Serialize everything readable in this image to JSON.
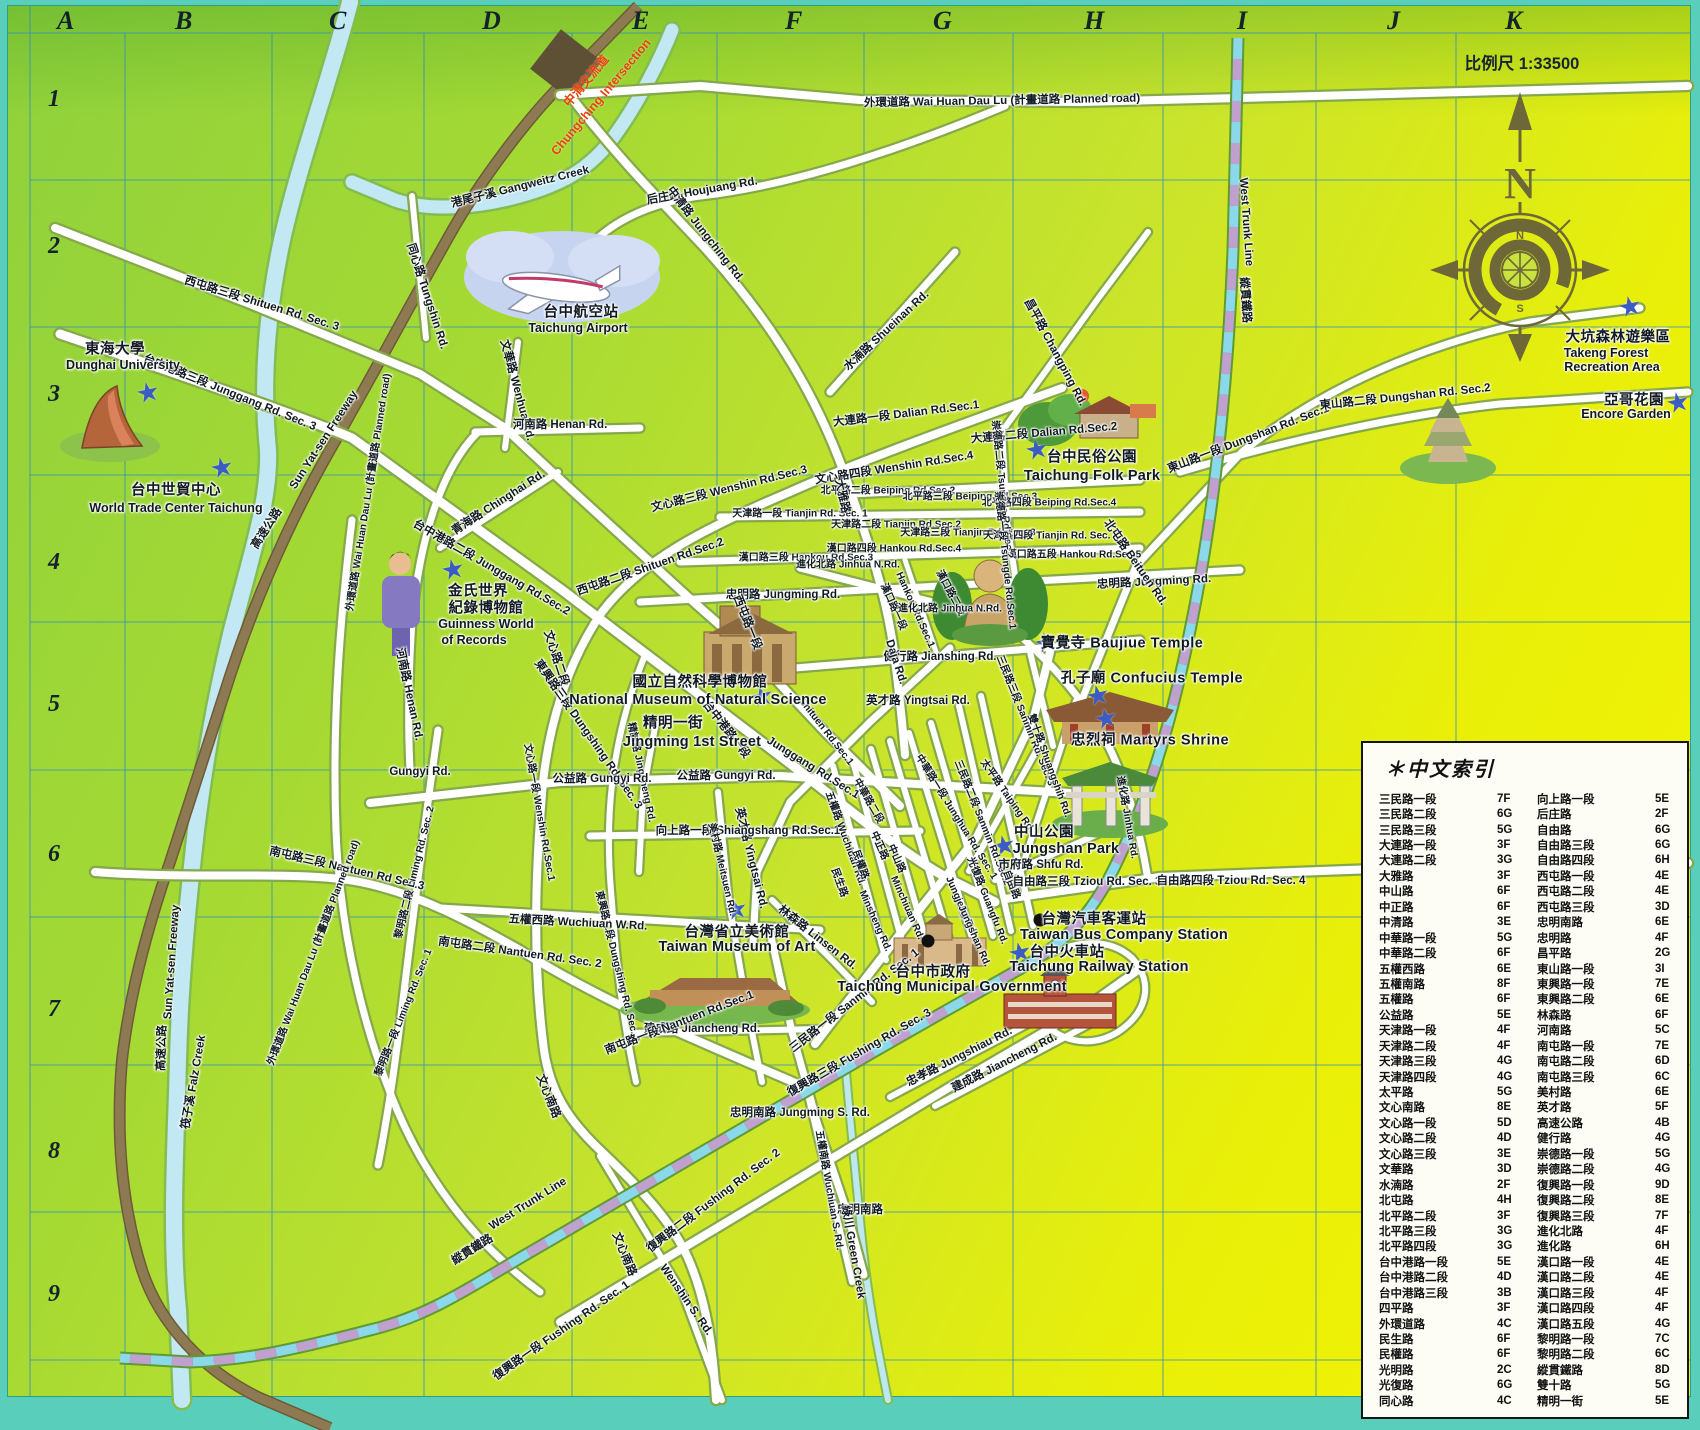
{
  "map": {
    "scale_label": "比例尺 1:33500",
    "compass": {
      "north": "N",
      "south": "S"
    },
    "grid": {
      "cols": [
        "A",
        "B",
        "C",
        "D",
        "E",
        "F",
        "G",
        "H",
        "I",
        "J",
        "K"
      ],
      "rows": [
        "1",
        "2",
        "3",
        "4",
        "5",
        "6",
        "7",
        "8",
        "9"
      ]
    },
    "index": {
      "title": "＊中文索引",
      "rows": [
        [
          "三民路一段",
          "7F",
          "向上路一段",
          "5E"
        ],
        [
          "三民路二段",
          "6G",
          "后庄路",
          "2F"
        ],
        [
          "三民路三段",
          "5G",
          "自由路",
          "6G"
        ],
        [
          "大連路一段",
          "3F",
          "自由路三段",
          "6G"
        ],
        [
          "大連路二段",
          "3G",
          "自由路四段",
          "6H"
        ],
        [
          "大雅路",
          "3F",
          "西屯路一段",
          "4E"
        ],
        [
          "中山路",
          "6F",
          "西屯路二段",
          "4E"
        ],
        [
          "中正路",
          "6F",
          "西屯路三段",
          "3D"
        ],
        [
          "中清路",
          "3E",
          "忠明南路",
          "6E"
        ],
        [
          "中華路一段",
          "5G",
          "忠明路",
          "4F"
        ],
        [
          "中華路二段",
          "6F",
          "昌平路",
          "2G"
        ],
        [
          "五權西路",
          "6E",
          "東山路一段",
          "3I"
        ],
        [
          "五權南路",
          "8F",
          "東興路一段",
          "7E"
        ],
        [
          "五權路",
          "6F",
          "東興路二段",
          "6E"
        ],
        [
          "公益路",
          "5E",
          "林森路",
          "6F"
        ],
        [
          "天津路一段",
          "4F",
          "河南路",
          "5C"
        ],
        [
          "天津路二段",
          "4F",
          "南屯路一段",
          "7E"
        ],
        [
          "天津路三段",
          "4G",
          "南屯路二段",
          "6D"
        ],
        [
          "天津路四段",
          "4G",
          "南屯路三段",
          "6C"
        ],
        [
          "太平路",
          "5G",
          "美村路",
          "6E"
        ],
        [
          "文心南路",
          "8E",
          "英才路",
          "5F"
        ],
        [
          "文心路一段",
          "5D",
          "高速公路",
          "4B"
        ],
        [
          "文心路二段",
          "4D",
          "健行路",
          "4G"
        ],
        [
          "文心路三段",
          "3E",
          "崇德路一段",
          "5G"
        ],
        [
          "文華路",
          "3D",
          "崇德路二段",
          "4G"
        ],
        [
          "水湳路",
          "2F",
          "復興路一段",
          "9D"
        ],
        [
          "北屯路",
          "4H",
          "復興路二段",
          "8E"
        ],
        [
          "北平路二段",
          "3F",
          "復興路三段",
          "7F"
        ],
        [
          "北平路三段",
          "3G",
          "進化北路",
          "4F"
        ],
        [
          "北平路四段",
          "3G",
          "進化路",
          "6H"
        ],
        [
          "台中港路一段",
          "5E",
          "漢口路一段",
          "4E"
        ],
        [
          "台中港路二段",
          "4D",
          "漢口路二段",
          "4E"
        ],
        [
          "台中港路三段",
          "3B",
          "漢口路三段",
          "4F"
        ],
        [
          "四平路",
          "3F",
          "漢口路四段",
          "4F"
        ],
        [
          "外環道路",
          "4C",
          "漢口路五段",
          "4G"
        ],
        [
          "民生路",
          "6F",
          "黎明路一段",
          "7C"
        ],
        [
          "民權路",
          "6F",
          "黎明路二段",
          "6C"
        ],
        [
          "光明路",
          "2C",
          "縱貫鐵路",
          "8D"
        ],
        [
          "光復路",
          "6G",
          "雙十路",
          "5G"
        ],
        [
          "同心路",
          "4C",
          "精明一街",
          "5E"
        ]
      ]
    },
    "labels": [
      [
        "外環道路 Wai Huan Dau Lu (計畫道路 Planned road)",
        1002,
        100,
        -1,
        ""
      ],
      [
        "后庄路 Houjuang Rd.",
        702,
        190,
        -10,
        ""
      ],
      [
        "港尾子溪 Gangweitz Creek",
        520,
        186,
        -14,
        ""
      ],
      [
        "中清路 Jungching Rd.",
        706,
        234,
        52,
        ""
      ],
      [
        "西屯路三段 Shituen Rd. Sec. 3",
        262,
        303,
        17,
        ""
      ],
      [
        "台中港路三段 Junggang Rd. Sec. 3",
        230,
        392,
        22,
        ""
      ],
      [
        "水湳路 Shueinan Rd.",
        886,
        330,
        -43,
        ""
      ],
      [
        "同心路 Tungshin Rd.",
        428,
        296,
        72,
        ""
      ],
      [
        "文華路 Wenhua Rd.",
        518,
        390,
        75,
        ""
      ],
      [
        "河南路 Henan Rd.",
        560,
        424,
        0,
        ""
      ],
      [
        "河南路 Henan Rd.",
        410,
        694,
        78,
        ""
      ],
      [
        "東山路一段 Dungshan Rd. Sec.1",
        1248,
        438,
        -21,
        ""
      ],
      [
        "東山路二段 Dungshan Rd. Sec.2",
        1405,
        396,
        -6,
        ""
      ],
      [
        "昌平路 Changping Rd.",
        1056,
        352,
        62,
        ""
      ],
      [
        "大連路一段 Dalian Rd.Sec.1",
        906,
        413,
        -7,
        ""
      ],
      [
        "大連路二段 Dalian Rd.Sec.2",
        1044,
        432,
        -5,
        ""
      ],
      [
        "文心路四段 Wenshin Rd.Sec.4",
        894,
        467,
        -9,
        ""
      ],
      [
        "北平路二段 Beiping Rd.Sec.2",
        888,
        489,
        0,
        "sm"
      ],
      [
        "北平路三段 Beiping Rd.Sec.3",
        970,
        495,
        0,
        "sm"
      ],
      [
        "北平路四段 Beiping Rd.Sec.4",
        1049,
        501,
        0,
        "sm"
      ],
      [
        "天津路一段 Tianjin Rd. Sec. 1",
        800,
        512,
        0,
        "sm"
      ],
      [
        "天津路二段 Tianjin Rd.Sec.2",
        896,
        523,
        0,
        "sm"
      ],
      [
        "天津路三段 Tianjin Rd. Sec. 3",
        968,
        531,
        0,
        "sm"
      ],
      [
        "天津路四段 Tianjin Rd. Sec. 4",
        1051,
        534,
        0,
        "sm"
      ],
      [
        "西屯路二段 Shituen Rd.Sec.2",
        650,
        566,
        -19,
        ""
      ],
      [
        "漢口路三段 Hankou Rd.Sec.3",
        806,
        556,
        0,
        "sm"
      ],
      [
        "漢口路四段 Hankou Rd.Sec.4",
        894,
        547,
        0,
        "sm"
      ],
      [
        "漢口路五段 Hankou Rd.Sec.5",
        1074,
        553,
        0,
        "sm"
      ],
      [
        "漢口路一段",
        895,
        606,
        66,
        "sm"
      ],
      [
        "Hankou Rd.Sec.1",
        915,
        610,
        66,
        "sm"
      ],
      [
        "漢口路二段",
        952,
        592,
        62,
        "sm"
      ],
      [
        "忠明路 Jungming Rd.",
        783,
        594,
        0,
        ""
      ],
      [
        "忠明路 Jungming Rd.",
        1154,
        581,
        -3,
        ""
      ],
      [
        "進化北路 Jinhua N.Rd.",
        848,
        563,
        0,
        "sm"
      ],
      [
        "進化北路 Jinhua N.Rd.",
        950,
        607,
        0,
        "sm"
      ],
      [
        "健行路 Jianshing Rd.",
        940,
        656,
        0,
        ""
      ],
      [
        "英才路 Yingtsai Rd.",
        918,
        700,
        0,
        ""
      ],
      [
        "英才路 Yingtsai Rd.",
        752,
        858,
        76,
        ""
      ],
      [
        "大雅路",
        843,
        496,
        78,
        ""
      ],
      [
        "Daja Rd.",
        896,
        662,
        72,
        ""
      ],
      [
        "北屯路 Beituen Rd.",
        1136,
        562,
        55,
        ""
      ],
      [
        "崇德路二段 Tsungde Rd.Sec.2",
        1004,
        489,
        84,
        "sm"
      ],
      [
        "崇德路一段 Tsungde Rd.Sec.1",
        1007,
        560,
        84,
        "sm"
      ],
      [
        "台中港路二段 Junggang Rd.Sec.2",
        492,
        567,
        30,
        ""
      ],
      [
        "台中港路一段",
        727,
        729,
        52,
        ""
      ],
      [
        "Junggang Rd.Sec.1",
        813,
        768,
        32,
        ""
      ],
      [
        "Shituen Rd.Sec.1",
        826,
        732,
        52,
        "sm"
      ],
      [
        "西屯路一段",
        748,
        622,
        68,
        ""
      ],
      [
        "文心路三段 Wenshin Rd.Sec.3",
        729,
        488,
        -14,
        ""
      ],
      [
        "文心路二段",
        557,
        658,
        72,
        ""
      ],
      [
        "文心路一段 Wenshin Rd.Sec.1",
        541,
        812,
        80,
        "sm"
      ],
      [
        "東興路三段 Dungshing Rd. Sec. 3",
        589,
        734,
        55,
        ""
      ],
      [
        "東興路二段 Dungshing Rd. Sec. 2",
        619,
        966,
        76,
        "sm"
      ],
      [
        "精誠路 Jingcheng Rd.",
        643,
        772,
        78,
        "sm"
      ],
      [
        "公益路 Gungyi Rd.",
        602,
        778,
        0,
        ""
      ],
      [
        "公益路 Gungyi Rd.",
        726,
        775,
        0,
        ""
      ],
      [
        "Gungyi Rd.",
        420,
        772,
        0,
        ""
      ],
      [
        "向上路一段 Shiangshang Rd.Sec.1",
        748,
        830,
        0,
        ""
      ],
      [
        "美村路 Meitsuen Rd.",
        724,
        869,
        77,
        "sm"
      ],
      [
        "林森路 Linsen Rd.",
        818,
        937,
        38,
        ""
      ],
      [
        "五權路 Wuchiuan Rd.",
        847,
        838,
        70,
        "sm"
      ],
      [
        "民生路",
        841,
        882,
        70,
        "sm"
      ],
      [
        "民權路",
        862,
        864,
        70,
        "sm"
      ],
      [
        "中正路",
        881,
        845,
        66,
        "sm"
      ],
      [
        "中山路",
        898,
        858,
        66,
        "sm"
      ],
      [
        "Minsheng Rd.",
        875,
        921,
        66,
        "sm"
      ],
      [
        "Minchiuan Rd.",
        907,
        908,
        66,
        "sm"
      ],
      [
        "Jungjeng Rd.",
        961,
        906,
        66,
        "sm"
      ],
      [
        "Jungshan Rd.",
        974,
        936,
        66,
        "sm"
      ],
      [
        "中華路一段 Junghua Rd. Sec. 1",
        958,
        816,
        58,
        "sm"
      ],
      [
        "中華路二段",
        870,
        800,
        60,
        "sm"
      ],
      [
        "太平路 Taiping Rd.",
        1009,
        795,
        55,
        "sm"
      ],
      [
        "三民路三段 Sanmin Rd. Sec. 3",
        1027,
        720,
        68,
        "sm"
      ],
      [
        "三民路二段 Sanmin Rd.Sec.2",
        984,
        822,
        68,
        "sm"
      ],
      [
        "三民路一段 Sanmin Rd. Sec. 1",
        854,
        1000,
        -38,
        ""
      ],
      [
        "雙十路 Shuangshih Rd.",
        1051,
        765,
        70,
        "sm"
      ],
      [
        "光復路 Guangfu Rd.",
        989,
        900,
        68,
        "sm"
      ],
      [
        "自由路",
        1013,
        884,
        68,
        "sm"
      ],
      [
        "市府路 Shfu Rd.",
        1041,
        864,
        0,
        ""
      ],
      [
        "自由路三段 Tziou Rd. Sec. 3",
        1087,
        881,
        0,
        ""
      ],
      [
        "自由路四段 Tziou Rd. Sec. 4",
        1231,
        880,
        0,
        ""
      ],
      [
        "進化路 Jinhua Rd.",
        1129,
        817,
        80,
        "sm"
      ],
      [
        "忠明南路 Jungming S. Rd.",
        800,
        1112,
        0,
        ""
      ],
      [
        "忠明南路",
        860,
        1209,
        0,
        ""
      ],
      [
        "五權南路 Wuchiuan S. Rd.",
        831,
        1190,
        80,
        "sm"
      ],
      [
        "綠川 Green Creek",
        854,
        1252,
        80,
        ""
      ],
      [
        "文心南路",
        549,
        1096,
        68,
        ""
      ],
      [
        "文心南路",
        625,
        1254,
        68,
        ""
      ],
      [
        "Wenshin S. Rd.",
        686,
        1300,
        55,
        ""
      ],
      [
        "復興路一段 Fushing Rd. Sec. 1",
        561,
        1330,
        -35,
        ""
      ],
      [
        "復興路二段 Fushing Rd. Sec. 2",
        713,
        1200,
        -37,
        ""
      ],
      [
        "復興路三段 Fushing Rd. Sec. 3",
        859,
        1052,
        -30,
        ""
      ],
      [
        "忠孝路 Jungshiau Rd.",
        959,
        1056,
        -27,
        ""
      ],
      [
        "建成路 Jiancheng Rd.",
        1004,
        1062,
        -27,
        ""
      ],
      [
        "建成路 Jiancheng Rd.",
        702,
        1028,
        0,
        ""
      ],
      [
        "南屯路一段 Nantuen Rd.Sec.1",
        679,
        1022,
        -21,
        ""
      ],
      [
        "南屯路二段 Nantuen Rd. Sec. 2",
        520,
        952,
        8,
        ""
      ],
      [
        "南屯路三段 Nantuen Rd Sec.3",
        347,
        868,
        13,
        ""
      ],
      [
        "黎明路二段 Liming Rd. Sec. 2",
        413,
        872,
        -76,
        "sm"
      ],
      [
        "黎明路一段 Liming Rd. Sec. 1",
        402,
        1012,
        -68,
        "sm"
      ],
      [
        "五權西路 Wuchiuan W.Rd.",
        578,
        922,
        3,
        ""
      ],
      [
        "外環道路 Wai Huan Dau Lu (計畫道路 Planned road)",
        367,
        492,
        -81,
        "sm"
      ],
      [
        "外環道路 Wai Huan Dau Lu (計畫道路 Planned road)",
        312,
        952,
        -69,
        "sm"
      ],
      [
        "Sun Yat-sen Freeway",
        324,
        440,
        -57,
        ""
      ],
      [
        "高速公路",
        266,
        528,
        -57,
        ""
      ],
      [
        "Sun Yat-sen Freeway",
        172,
        962,
        -86,
        ""
      ],
      [
        "高速公路",
        161,
        1048,
        -88,
        ""
      ],
      [
        "筏子溪 Falz Creek",
        193,
        1082,
        -80,
        ""
      ],
      [
        "青海路 Chinghai Rd.",
        498,
        502,
        -33,
        ""
      ],
      [
        "West Trunk Line",
        1246,
        222,
        86,
        ""
      ],
      [
        "縱貫鐵路",
        1246,
        300,
        86,
        ""
      ],
      [
        "West Trunk Line",
        528,
        1204,
        -32,
        ""
      ],
      [
        "縱貫鐵路",
        472,
        1249,
        -32,
        ""
      ],
      [
        "中清交流道",
        585,
        80,
        -50,
        "red"
      ],
      [
        "Chungching Intersection",
        601,
        97,
        -50,
        "red"
      ],
      [
        "東海大學",
        115,
        348,
        0,
        "lm"
      ],
      [
        "Dunghai University",
        123,
        365,
        0,
        "en"
      ],
      [
        "台中世貿中心",
        176,
        489,
        0,
        "lm"
      ],
      [
        "World Trade Center Taichung",
        176,
        508,
        0,
        "en"
      ],
      [
        "金氏世界",
        478,
        590,
        0,
        "lm"
      ],
      [
        "紀錄博物館",
        486,
        607,
        0,
        "lm"
      ],
      [
        "Guinness World",
        486,
        624,
        0,
        "en"
      ],
      [
        "of Records",
        474,
        640,
        0,
        "en"
      ],
      [
        "台中航空站",
        581,
        311,
        0,
        "lm"
      ],
      [
        "Taichung Airport",
        578,
        328,
        0,
        "en"
      ],
      [
        "台中民俗公園",
        1092,
        456,
        0,
        "lm"
      ],
      [
        "Taichung Folk Park",
        1092,
        476,
        0,
        "enl"
      ],
      [
        "國立自然科學博物館",
        700,
        681,
        0,
        "lm"
      ],
      [
        "National Museum of Natural Science",
        698,
        700,
        0,
        "enl"
      ],
      [
        "精明一街",
        673,
        722,
        0,
        "lm"
      ],
      [
        "Jingming 1st Street",
        692,
        742,
        0,
        "enl"
      ],
      [
        "寶覺寺 Baujiue Temple",
        1122,
        642,
        0,
        "lm"
      ],
      [
        "孔子廟 Confucius Temple",
        1152,
        677,
        0,
        "lm"
      ],
      [
        "忠烈祠 Martyrs Shrine",
        1150,
        739,
        0,
        "lm"
      ],
      [
        "中山公園",
        1044,
        831,
        0,
        "lm"
      ],
      [
        "Jungshan Park",
        1066,
        849,
        0,
        "enl"
      ],
      [
        "台灣汽車客運站",
        1094,
        918,
        0,
        "lm"
      ],
      [
        "Taiwan Bus Company Station",
        1124,
        935,
        0,
        "enl"
      ],
      [
        "台中火車站",
        1067,
        951,
        0,
        "lm"
      ],
      [
        "Taichung Railway Station",
        1099,
        967,
        0,
        "enl"
      ],
      [
        "台灣省立美術館",
        737,
        931,
        0,
        "lm"
      ],
      [
        "Taiwan Museum of Art",
        737,
        947,
        0,
        "enl"
      ],
      [
        "台中市政府",
        933,
        971,
        0,
        "lm"
      ],
      [
        "Taichung Municipal Government",
        952,
        987,
        0,
        "enl"
      ],
      [
        "大坑森林遊樂區",
        1618,
        336,
        0,
        "lm"
      ],
      [
        "Takeng Forest",
        1606,
        353,
        0,
        "en"
      ],
      [
        "Recreation Area",
        1612,
        367,
        0,
        "en"
      ],
      [
        "亞哥花園",
        1634,
        399,
        0,
        "lm"
      ],
      [
        "Encore Garden",
        1626,
        414,
        0,
        "en"
      ]
    ],
    "stars": [
      [
        148,
        393
      ],
      [
        222,
        468
      ],
      [
        453,
        570
      ],
      [
        762,
        697
      ],
      [
        1037,
        450
      ],
      [
        1046,
        643
      ],
      [
        1098,
        696
      ],
      [
        1106,
        719
      ],
      [
        1004,
        846
      ],
      [
        1020,
        953
      ],
      [
        736,
        910
      ],
      [
        1630,
        307
      ],
      [
        1678,
        403
      ]
    ],
    "dots": [
      [
        1040,
        920
      ],
      [
        928,
        941
      ]
    ]
  }
}
